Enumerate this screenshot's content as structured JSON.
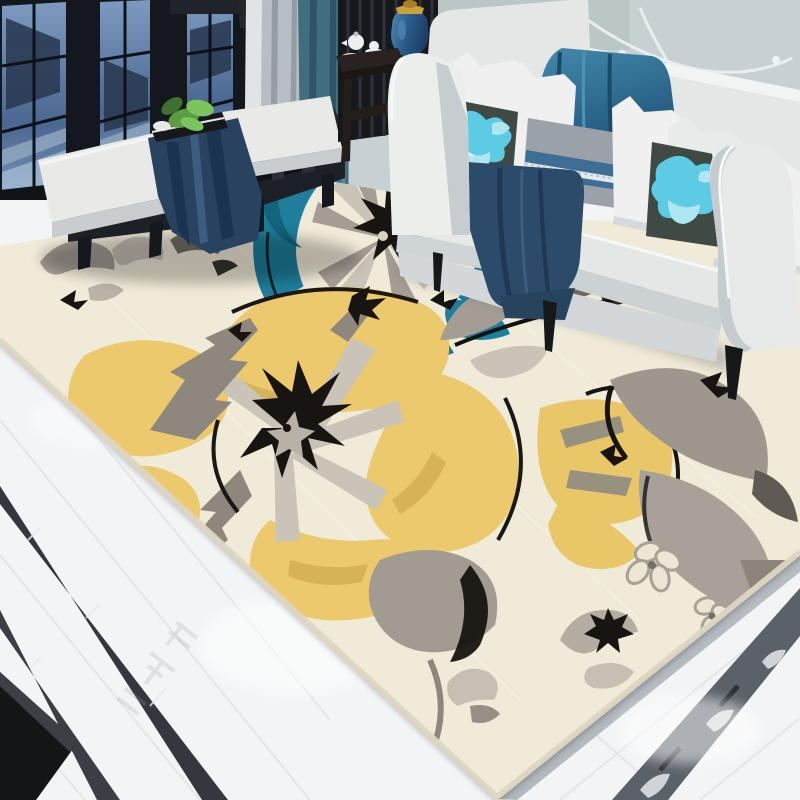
{
  "scene": {
    "alt": "Modern living room photo: black-framed windows, white sofa with blue pillows, dark window bench, and a large cream area rug with yellow, grey and teal painterly flowers on a white marble floor",
    "objects": [
      "window-wall",
      "curtains",
      "wallpaper",
      "window-bench",
      "side-table",
      "blue-jar",
      "sofa",
      "pillows",
      "teal-drape",
      "navy-blanket",
      "floral-area-rug",
      "marble-floor",
      "border-strips"
    ]
  },
  "palette": {
    "wallpaper": "#c7d0d3",
    "branch": "#edf2f2",
    "twig": "#9aabb0",
    "glassPanel": "#b9c4c3",
    "windowFrame": "#14181e",
    "glassTop": "#89a4c4",
    "glassBottom": "#3d5880",
    "glassLight": "#a9c1da",
    "silhouette": "#27374e",
    "railLight": "#93a9c3",
    "pilaster": "#dfe4e7",
    "valance": "#20242a",
    "cabinet": "#23262b",
    "curtainGray": "#b6bdc4",
    "curtainGrayFold": "#949ca4",
    "curtainTeal": "#406e7e",
    "curtainTealFold": "#2d5565",
    "wallBase": "#e8eaec",
    "sillDark": "#101318",
    "floor": "#f3f4f6",
    "grout": "#d9dce0",
    "floorStripA": "#34383e",
    "floorStripB": "#3b3f45",
    "vein": "#e8eaed",
    "chromeLight": "#eef1f3",
    "chromeMid": "#9aa1a8",
    "ornate": "#5b6169",
    "ornateDark": "#2d3137",
    "ornateFloral": "#dde1e4",
    "watermark": "#9aa0a7",
    "rugBase": "#f0ead9",
    "rugCreamHi": "#f7f2e4",
    "rugTeal": "#1e7e9b",
    "rugTealDark": "#14637c",
    "rugYellow": "#ecc96d",
    "rugYellowDeep": "#d8b257",
    "rugGray": "#a49d94",
    "rugGrayDark": "#746f67",
    "rugGrayDeep": "#57534d",
    "rugSilver": "#c9c3b8",
    "rugBlack": "#171411",
    "rugLightPetal": "#c6c0b4",
    "rugMidPetal": "#958f85",
    "sofaWhite": "#eceeec",
    "sofaPanel": "#e4e7e6",
    "sofaShade": "#c7ccd0",
    "sofaBase": "#d3d7d9",
    "pillowWhite": "#eff0ef",
    "pillowShade": "#d5d9db",
    "floralBase": "#3f4a44",
    "floralCyan": "#5ecbe4",
    "floralLight": "#aee6f2",
    "pillowGray": "#9aa1a9",
    "pillowBlueBand": "#3e6e95",
    "lace": "#e6e9ea",
    "drapeTeal": "#2f6a8c",
    "drapeTealDark": "#1c4a66",
    "blanketNavy": "#2c4a69",
    "blanketNavyDark": "#1e3853",
    "benchWood": "#22262e",
    "benchWoodDark": "#15181d",
    "runnerNavy": "#28425f",
    "runnerNavyDark": "#1b3350",
    "cushionWhite": "#e9eae8",
    "cushionShade": "#c9cdd0",
    "plantGreen": "#5d9c42",
    "plantGreenLight": "#7cc45c",
    "bookDark": "#17181c",
    "tableWood": "#292220",
    "teaWhite": "#eceff0",
    "jarBlue": "#2a5c8c",
    "jarBlueDark": "#1d3f66",
    "gold": "#c9a23c",
    "legBlack": "#17181a"
  }
}
